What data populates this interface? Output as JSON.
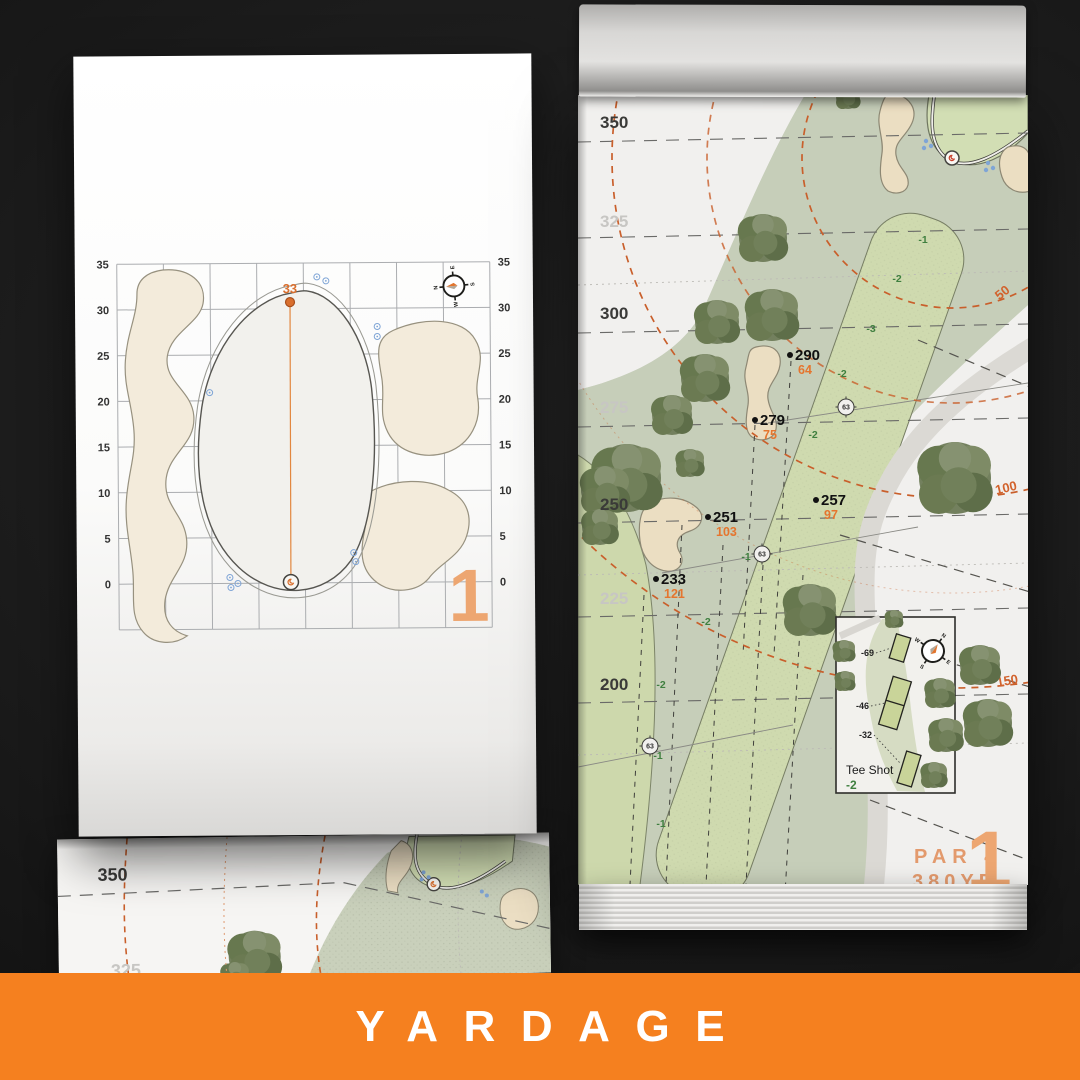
{
  "banner": {
    "title": "YARDAGE"
  },
  "colors": {
    "banner_orange": "#f5801f",
    "page_number_orange": "#eda671",
    "marker_orange": "#e5752e",
    "slope_green": "#3f7f3f",
    "arc_orange": "#c95f2b",
    "sprinkler_blue": "#7fa5d6"
  },
  "green_chart": {
    "page_number": "1",
    "pin_distance_label": "33",
    "axis_ticks": [
      "35",
      "30",
      "25",
      "20",
      "15",
      "10",
      "5",
      "0"
    ],
    "compass_points": [
      "N",
      "E",
      "S",
      "W"
    ]
  },
  "hole_map": {
    "page_number": "1",
    "par_label": "PAR 4",
    "distance_label": "380YD",
    "compass_points": [
      "N",
      "E",
      "S",
      "W"
    ],
    "edge_distances": [
      {
        "value": "350",
        "faded": false,
        "y": 33
      },
      {
        "value": "325",
        "faded": true,
        "y": 132
      },
      {
        "value": "300",
        "faded": false,
        "y": 224
      },
      {
        "value": "275",
        "faded": true,
        "y": 318
      },
      {
        "value": "250",
        "faded": false,
        "y": 415
      },
      {
        "value": "225",
        "faded": true,
        "y": 509
      },
      {
        "value": "200",
        "faded": false,
        "y": 595
      }
    ],
    "arc_distances": [
      {
        "value": "50",
        "x": 427,
        "y": 201,
        "rotate": -38
      },
      {
        "value": "100",
        "x": 429,
        "y": 397,
        "rotate": -13
      },
      {
        "value": "150",
        "x": 430,
        "y": 590,
        "rotate": -10
      }
    ],
    "carry_markers": [
      {
        "carry": "290",
        "to_green": "64",
        "x": 212,
        "y": 260
      },
      {
        "carry": "279",
        "to_green": "75",
        "x": 177,
        "y": 325
      },
      {
        "carry": "257",
        "to_green": "97",
        "x": 238,
        "y": 405
      },
      {
        "carry": "251",
        "to_green": "103",
        "x": 130,
        "y": 422
      },
      {
        "carry": "233",
        "to_green": "121",
        "x": 78,
        "y": 484
      }
    ],
    "sprinklers": [
      {
        "value": "63",
        "x": 268,
        "y": 312
      },
      {
        "value": "63",
        "x": 184,
        "y": 459
      },
      {
        "value": "63",
        "x": 72,
        "y": 651
      }
    ],
    "slopes": [
      {
        "value": "-1",
        "x": 345,
        "y": 148
      },
      {
        "value": "-2",
        "x": 319,
        "y": 187
      },
      {
        "value": "-3",
        "x": 293,
        "y": 237
      },
      {
        "value": "-2",
        "x": 264,
        "y": 282
      },
      {
        "value": "-2",
        "x": 235,
        "y": 343
      },
      {
        "value": "-1",
        "x": 168,
        "y": 465
      },
      {
        "value": "-2",
        "x": 128,
        "y": 530
      },
      {
        "value": "-2",
        "x": 83,
        "y": 593
      },
      {
        "value": "-1",
        "x": 80,
        "y": 664
      },
      {
        "value": "-1",
        "x": 83,
        "y": 732
      }
    ],
    "tee_inset": {
      "title": "Tee Shot",
      "shot_value": "-2",
      "tee_distances": [
        {
          "value": "-69",
          "x": 296,
          "y": 561
        },
        {
          "value": "-46",
          "x": 291,
          "y": 614
        },
        {
          "value": "-32",
          "x": 294,
          "y": 643
        }
      ]
    }
  },
  "peek_page": {
    "edge_distances": [
      {
        "value": "350",
        "faded": false,
        "x": 40,
        "y": 42
      },
      {
        "value": "325",
        "faded": true,
        "x": 52,
        "y": 138
      }
    ]
  }
}
